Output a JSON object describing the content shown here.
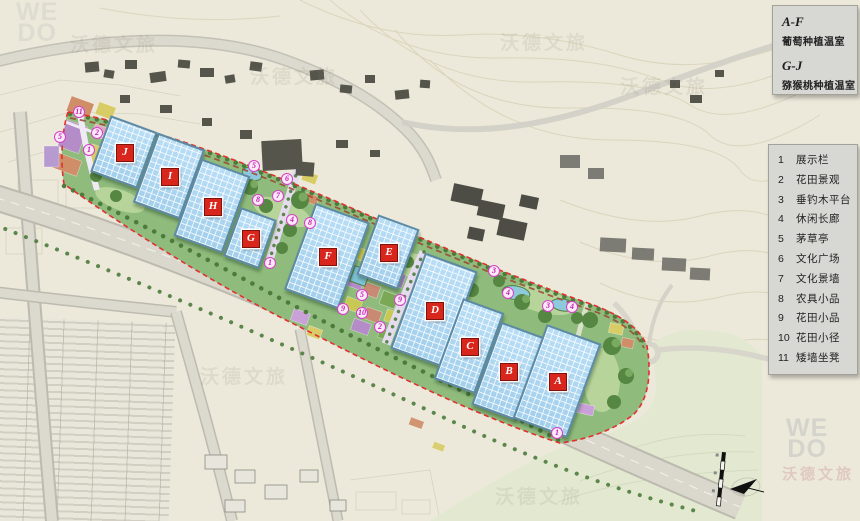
{
  "legend_top": {
    "groups": [
      {
        "range": "A-F",
        "label": "葡萄种植温室"
      },
      {
        "range": "G-J",
        "label": "猕猴桃种植温室"
      }
    ]
  },
  "legend_items": [
    {
      "num": "1",
      "label": "展示栏"
    },
    {
      "num": "2",
      "label": "花田景观"
    },
    {
      "num": "3",
      "label": "垂钓木平台"
    },
    {
      "num": "4",
      "label": "休闲长廊"
    },
    {
      "num": "5",
      "label": "茅草亭"
    },
    {
      "num": "6",
      "label": "文化广场"
    },
    {
      "num": "7",
      "label": "文化景墙"
    },
    {
      "num": "8",
      "label": "农具小品"
    },
    {
      "num": "9",
      "label": "花田小品"
    },
    {
      "num": "10",
      "label": "花田小径"
    },
    {
      "num": "11",
      "label": "矮墙坐凳"
    }
  ],
  "watermark": {
    "text": "沃德文旅",
    "logo_line1": "WE",
    "logo_line2": "DO"
  },
  "map": {
    "colors": {
      "greenhouse_blue": "#aed6f2",
      "site_green": "#8fbb7c",
      "boundary_red": "#e23030",
      "marker_pink": "#d63ec8",
      "label_red": "#d9261c"
    },
    "greenhouses": [
      {
        "letter": "J",
        "cx": 124,
        "cy": 152,
        "w": 50,
        "h": 60,
        "rot": 20
      },
      {
        "letter": "I",
        "cx": 169,
        "cy": 176,
        "w": 50,
        "h": 74,
        "rot": 20
      },
      {
        "letter": "H",
        "cx": 212,
        "cy": 206,
        "w": 52,
        "h": 82,
        "rot": 20
      },
      {
        "letter": "G",
        "cx": 250,
        "cy": 238,
        "w": 38,
        "h": 52,
        "rot": 20
      },
      {
        "letter": "F",
        "cx": 327,
        "cy": 256,
        "w": 58,
        "h": 92,
        "rot": 20
      },
      {
        "letter": "E",
        "cx": 388,
        "cy": 252,
        "w": 44,
        "h": 64,
        "rot": 20
      },
      {
        "letter": "D",
        "cx": 434,
        "cy": 310,
        "w": 56,
        "h": 102,
        "rot": 20
      },
      {
        "letter": "C",
        "cx": 469,
        "cy": 346,
        "w": 44,
        "h": 86,
        "rot": 20
      },
      {
        "letter": "B",
        "cx": 508,
        "cy": 371,
        "w": 46,
        "h": 88,
        "rot": 20
      },
      {
        "letter": "A",
        "cx": 557,
        "cy": 381,
        "w": 58,
        "h": 100,
        "rot": 20
      }
    ],
    "markers": [
      {
        "num": "11",
        "x": 79,
        "y": 112
      },
      {
        "num": "2",
        "x": 97,
        "y": 133
      },
      {
        "num": "5",
        "x": 60,
        "y": 137
      },
      {
        "num": "1",
        "x": 89,
        "y": 150
      },
      {
        "num": "5",
        "x": 254,
        "y": 166
      },
      {
        "num": "6",
        "x": 287,
        "y": 179
      },
      {
        "num": "7",
        "x": 278,
        "y": 196
      },
      {
        "num": "8",
        "x": 258,
        "y": 200
      },
      {
        "num": "4",
        "x": 292,
        "y": 220
      },
      {
        "num": "8",
        "x": 310,
        "y": 223
      },
      {
        "num": "1",
        "x": 270,
        "y": 263
      },
      {
        "num": "5",
        "x": 362,
        "y": 295
      },
      {
        "num": "9",
        "x": 400,
        "y": 300
      },
      {
        "num": "9",
        "x": 343,
        "y": 309
      },
      {
        "num": "10",
        "x": 362,
        "y": 313
      },
      {
        "num": "2",
        "x": 380,
        "y": 327
      },
      {
        "num": "3",
        "x": 494,
        "y": 271
      },
      {
        "num": "4",
        "x": 508,
        "y": 293
      },
      {
        "num": "3",
        "x": 548,
        "y": 306
      },
      {
        "num": "4",
        "x": 572,
        "y": 307
      },
      {
        "num": "1",
        "x": 557,
        "y": 433
      }
    ],
    "watermarks": [
      {
        "x": 70,
        "y": 30,
        "variant": "tan"
      },
      {
        "x": 250,
        "y": 62,
        "variant": "tan"
      },
      {
        "x": 500,
        "y": 28,
        "variant": "tan"
      },
      {
        "x": 620,
        "y": 72,
        "variant": "tan"
      },
      {
        "x": 200,
        "y": 362,
        "variant": "tan"
      },
      {
        "x": 495,
        "y": 482,
        "variant": "tan"
      },
      {
        "x": 782,
        "y": 463,
        "variant": "pink"
      }
    ]
  }
}
